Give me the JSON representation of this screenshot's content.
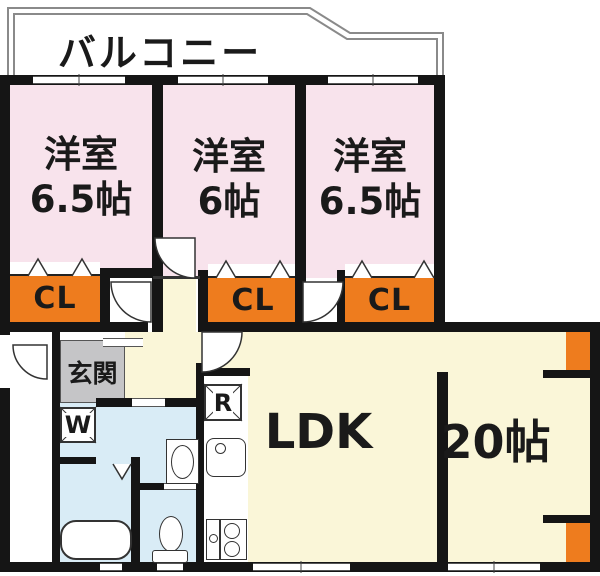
{
  "balcony": {
    "label": "バルコニー"
  },
  "rooms": [
    {
      "name": "洋室",
      "size": "6.5帖"
    },
    {
      "name": "洋室",
      "size": "6帖"
    },
    {
      "name": "洋室",
      "size": "6.5帖"
    }
  ],
  "closets": [
    {
      "label": "CL"
    },
    {
      "label": "CL"
    },
    {
      "label": "CL"
    }
  ],
  "entrance": {
    "label": "玄関"
  },
  "washer": {
    "label": "W"
  },
  "refrigerator": {
    "label": "R"
  },
  "living": {
    "label": "LDK"
  },
  "main_room": {
    "label": "20帖"
  },
  "colors": {
    "room_pink": "#f8e3ec",
    "floor_beige": "#faf6d8",
    "closet_orange": "#ee7c1e",
    "entrance_gray": "#c5c5c7",
    "wet_blue": "#d9ecf6",
    "wall_black": "#151515"
  }
}
